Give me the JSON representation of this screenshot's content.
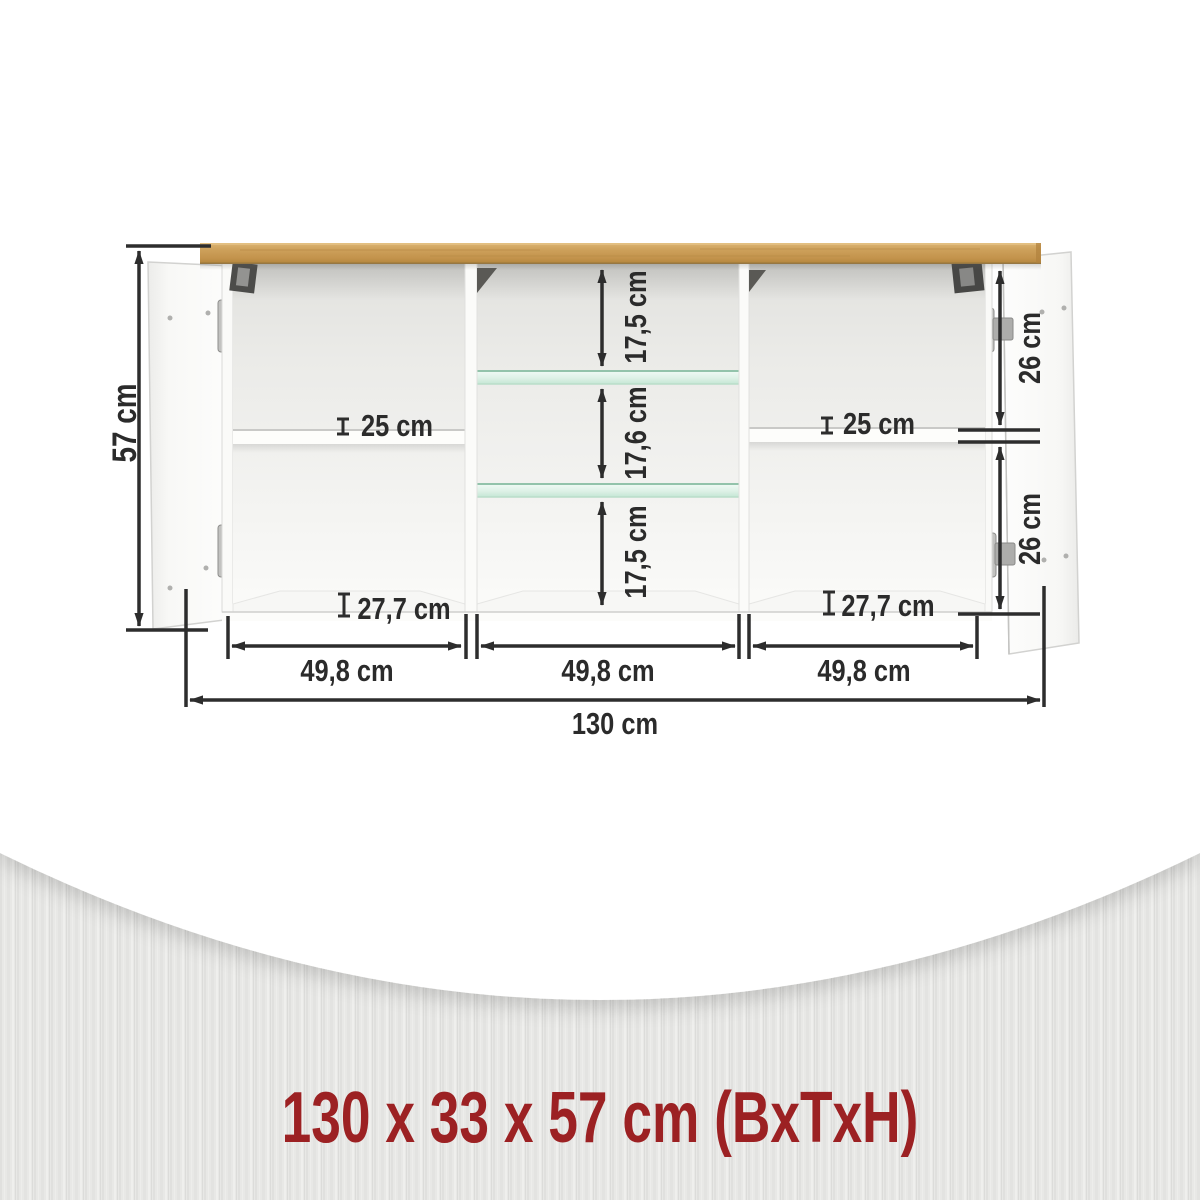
{
  "product": {
    "kind": "sideboard-dimension-diagram",
    "footer": {
      "summary": "130 x 33 x 57 cm (BxTxH)",
      "color": "#9c2123"
    },
    "dims": {
      "height": "57 cm",
      "total_width": "130 cm",
      "width_left": "49,8 cm",
      "width_middle": "49,8 cm",
      "width_right": "49,8 cm",
      "middle_top": "17,5 cm",
      "middle_center": "17,6 cm",
      "middle_bottom": "17,5 cm",
      "right_top": "26 cm",
      "right_bottom": "26 cm",
      "shelf_left": "25 cm",
      "shelf_right": "25 cm",
      "lower_left": "27,7 cm",
      "lower_right": "27,7 cm"
    },
    "colors": {
      "wood": "#c99b52",
      "glass": "#cfe9da",
      "dimension_line": "#2d2d2d",
      "background_texture": "#e8e8e6"
    }
  }
}
